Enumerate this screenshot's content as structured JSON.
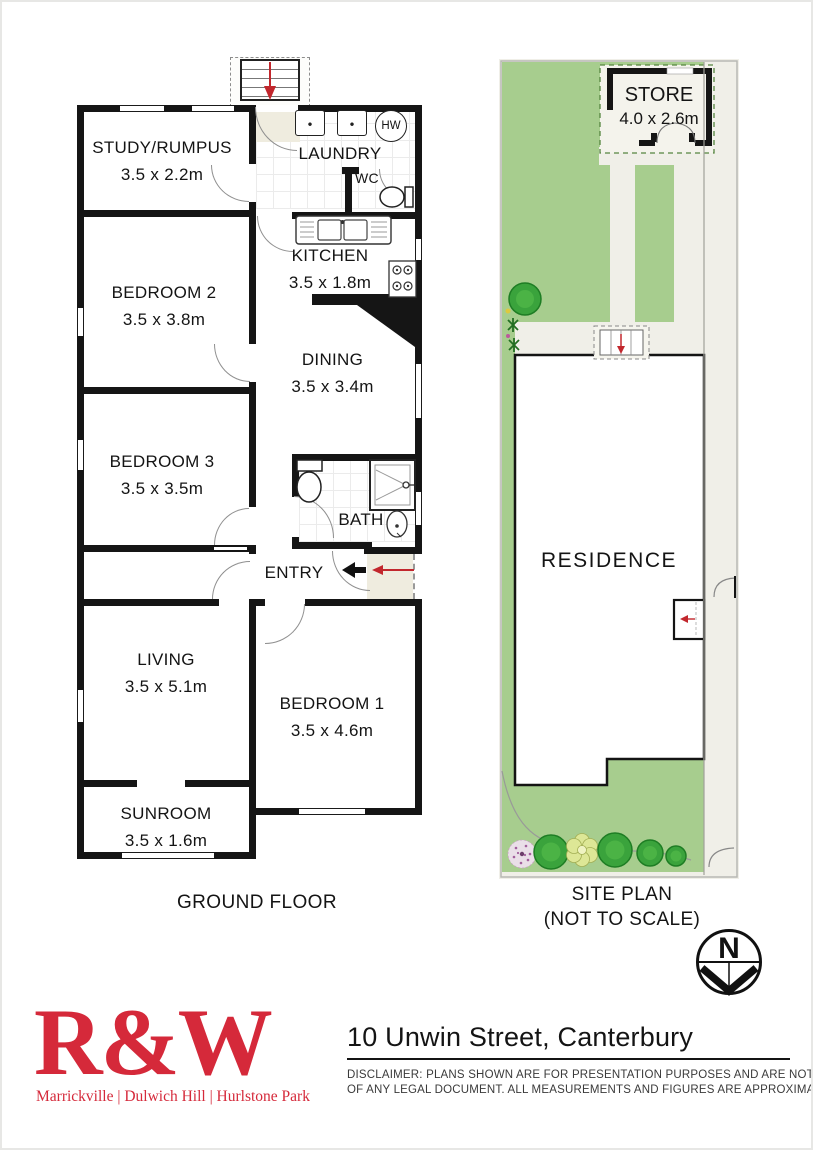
{
  "floor_plan": {
    "title": "GROUND FLOOR",
    "rooms": {
      "study": {
        "name": "STUDY/RUMPUS",
        "dims": "3.5 x 2.2m"
      },
      "laundry": {
        "name": "LAUNDRY"
      },
      "wc": {
        "name": "WC"
      },
      "hw": {
        "label": "HW"
      },
      "kitchen": {
        "name": "KITCHEN",
        "dims": "3.5 x 1.8m"
      },
      "bedroom2": {
        "name": "BEDROOM 2",
        "dims": "3.5 x 3.8m"
      },
      "dining": {
        "name": "DINING",
        "dims": "3.5 x 3.4m"
      },
      "bedroom3": {
        "name": "BEDROOM 3",
        "dims": "3.5 x 3.5m"
      },
      "bath": {
        "name": "BATH"
      },
      "entry": {
        "name": "ENTRY"
      },
      "living": {
        "name": "LIVING",
        "dims": "3.5 x 5.1m"
      },
      "bedroom1": {
        "name": "BEDROOM 1",
        "dims": "3.5 x 4.6m"
      },
      "sunroom": {
        "name": "SUNROOM",
        "dims": "3.5 x 1.6m"
      }
    }
  },
  "site_plan": {
    "title": "SITE PLAN",
    "subtitle": "(NOT TO SCALE)",
    "store_name": "STORE",
    "store_dims": "4.0 x 2.6m",
    "residence_name": "RESIDENCE",
    "north_label": "N"
  },
  "footer": {
    "brand": "R&W",
    "offices": "Marrickville | Dulwich Hill | Hurlstone Park",
    "address": "10 Unwin Street, Canterbury",
    "disclaimer1": "DISCLAIMER:  PLANS SHOWN ARE FOR PRESENTATION PURPOSES AND ARE NOT PART",
    "disclaimer2": "OF ANY LEGAL DOCUMENT. ALL MEASUREMENTS AND FIGURES ARE APPROXIMATE."
  },
  "colors": {
    "brand_red": "#d5293a",
    "arrow_red": "#c2272d",
    "lawn_green": "#a7cd8e",
    "wall_black": "#151515"
  }
}
